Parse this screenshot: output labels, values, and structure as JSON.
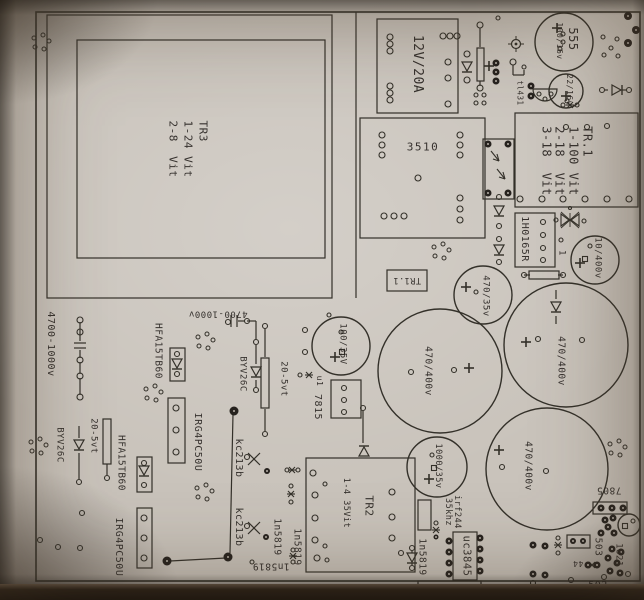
{
  "title": "Photographed PCB component placement drawing (switch-mode power supply board)",
  "colors": {
    "paper": "#c9c3bb",
    "ink": "#333029",
    "text": "#2a2622",
    "pad_dark": "#26221e",
    "backdrop": "#171310"
  },
  "labels": [
    {
      "n": "label-tr3-winding",
      "t": "TR3\n1-24 Vit\n2-8  Vit",
      "x": 187,
      "y": 149,
      "r": 90,
      "s": 11,
      "l": 1.35
    },
    {
      "n": "label-transformer-12v20a",
      "t": "12V/20A",
      "x": 417,
      "y": 64,
      "r": 90,
      "s": 13
    },
    {
      "n": "label-cap-100-16v",
      "t": "100/16v",
      "x": 559,
      "y": 41,
      "r": 90,
      "s": 8
    },
    {
      "n": "label-cap-555",
      "t": "555",
      "x": 573,
      "y": 39,
      "r": 90,
      "s": 12
    },
    {
      "n": "label-cap-22-16v",
      "t": "22/16v",
      "x": 569,
      "y": 90,
      "r": 90,
      "s": 8
    },
    {
      "n": "label-tl431",
      "t": "tl431",
      "x": 520,
      "y": 93,
      "r": 90,
      "s": 7.5
    },
    {
      "n": "label-tr1-winding",
      "t": "TR.1\n1-100 Vit\n2-18  Vit\n3-18  Vit",
      "x": 566,
      "y": 161,
      "r": 90,
      "s": 12,
      "l": 1.15
    },
    {
      "n": "label-ic-1h0165r",
      "t": "1H0165R",
      "x": 524,
      "y": 239,
      "r": 90,
      "s": 10
    },
    {
      "n": "label-pin-1",
      "t": "1",
      "x": 561,
      "y": 253,
      "r": 90,
      "s": 9
    },
    {
      "n": "label-cap-10-400v",
      "t": "10/400v",
      "x": 597,
      "y": 258,
      "r": 90,
      "s": 9
    },
    {
      "n": "label-bridge-3510",
      "t": "3510",
      "x": 423,
      "y": 147,
      "r": 0,
      "s": 11,
      "sp": 1.5
    },
    {
      "n": "label-tr1-1",
      "t": "TR1.1",
      "x": 407,
      "y": 280,
      "r": 180,
      "s": 8.5
    },
    {
      "n": "label-cap-470-35v",
      "t": "470/35v",
      "x": 485,
      "y": 296,
      "r": 90,
      "s": 9
    },
    {
      "n": "label-cap-470-400v-a",
      "t": "470/400v",
      "x": 428,
      "y": 371,
      "r": 90,
      "s": 9.5
    },
    {
      "n": "label-cap-470-400v-b",
      "t": "470/400v",
      "x": 561,
      "y": 361,
      "r": 90,
      "s": 9.5
    },
    {
      "n": "label-cap-470-400v-c",
      "t": "470/400v",
      "x": 528,
      "y": 466,
      "r": 90,
      "s": 9.5
    },
    {
      "n": "label-cap-100-35v",
      "t": "100/35V",
      "x": 342,
      "y": 344,
      "r": 90,
      "s": 9
    },
    {
      "n": "label-u1",
      "t": "u1",
      "x": 319,
      "y": 381,
      "r": 90,
      "s": 8
    },
    {
      "n": "label-reg-7815",
      "t": "7815",
      "x": 317,
      "y": 407,
      "r": 90,
      "s": 10
    },
    {
      "n": "label-tr2",
      "t": "TR2",
      "x": 369,
      "y": 506,
      "r": 90,
      "s": 11
    },
    {
      "n": "label-tr2-winding",
      "t": "1-4 35Vit",
      "x": 346,
      "y": 503,
      "r": 90,
      "s": 8.5
    },
    {
      "n": "label-kc213b-a",
      "t": "kc213b",
      "x": 238,
      "y": 458,
      "r": 90,
      "s": 10
    },
    {
      "n": "label-kc213b-b",
      "t": "kc213b",
      "x": 238,
      "y": 527,
      "r": 90,
      "s": 10
    },
    {
      "n": "label-1n5819-a",
      "t": "1n5819",
      "x": 277,
      "y": 537,
      "r": 90,
      "s": 9.5
    },
    {
      "n": "label-1n5819-b",
      "t": "1n5819",
      "x": 297,
      "y": 547,
      "r": 90,
      "s": 9.5
    },
    {
      "n": "label-1n5819-c",
      "t": "1n5819",
      "x": 271,
      "y": 566,
      "r": 180,
      "s": 9.5
    },
    {
      "n": "label-1n5819-d",
      "t": "1n5819",
      "x": 422,
      "y": 557,
      "r": 90,
      "s": 9.5
    },
    {
      "n": "label-cap-1000-35v",
      "t": "1000/35v",
      "x": 438,
      "y": 466,
      "r": 90,
      "s": 8.5
    },
    {
      "n": "label-35khz",
      "t": "35khz",
      "x": 448,
      "y": 512,
      "r": 90,
      "s": 8.5
    },
    {
      "n": "label-irf244",
      "t": "irf244",
      "x": 457,
      "y": 512,
      "r": 90,
      "s": 8.5
    },
    {
      "n": "label-ic-uc3845",
      "t": "uc3845",
      "x": 466,
      "y": 556,
      "r": 90,
      "s": 10.5
    },
    {
      "n": "label-reg-7805",
      "t": "7805",
      "x": 609,
      "y": 490,
      "r": 180,
      "s": 9.5
    },
    {
      "n": "label-503",
      "t": "503",
      "x": 598,
      "y": 547,
      "r": 90,
      "s": 9.5
    },
    {
      "n": "label-1821",
      "t": "1821",
      "x": 618,
      "y": 555,
      "r": 90,
      "s": 9
    },
    {
      "n": "label-502",
      "t": "502",
      "x": 598,
      "y": 586,
      "r": 0,
      "s": 10
    },
    {
      "n": "label-44",
      "t": "44",
      "x": 578,
      "y": 563,
      "r": 180,
      "s": 8
    },
    {
      "n": "label-cap-4700-1000v-a",
      "t": "4700-1000v",
      "x": 50,
      "y": 344,
      "r": 90,
      "s": 10
    },
    {
      "n": "label-cap-4700-1000v-b",
      "t": "4700-1000v",
      "x": 218,
      "y": 313,
      "r": 180,
      "s": 9
    },
    {
      "n": "label-byv26c-a",
      "t": "BYV26C",
      "x": 242,
      "y": 374,
      "r": 90,
      "s": 9
    },
    {
      "n": "label-20-5vt-a",
      "t": "20-5vt",
      "x": 283,
      "y": 379,
      "r": 90,
      "s": 9
    },
    {
      "n": "label-hfa15tb60-a",
      "t": "HFA15TB60",
      "x": 158,
      "y": 351,
      "r": 90,
      "s": 9.5
    },
    {
      "n": "label-irg4pc50u-a",
      "t": "IRG4PC50U",
      "x": 197,
      "y": 442,
      "r": 90,
      "s": 10
    },
    {
      "n": "label-byv26c-b",
      "t": "BYV26C",
      "x": 59,
      "y": 445,
      "r": 90,
      "s": 9
    },
    {
      "n": "label-20-5vt-b",
      "t": "20-5vt",
      "x": 93,
      "y": 436,
      "r": 90,
      "s": 9
    },
    {
      "n": "label-hfa15tb60-b",
      "t": "HFA15TB60",
      "x": 121,
      "y": 463,
      "r": 90,
      "s": 9.5
    },
    {
      "n": "label-irg4pc50u-b",
      "t": "IRG4PC50U",
      "x": 118,
      "y": 547,
      "r": 90,
      "s": 10
    }
  ]
}
